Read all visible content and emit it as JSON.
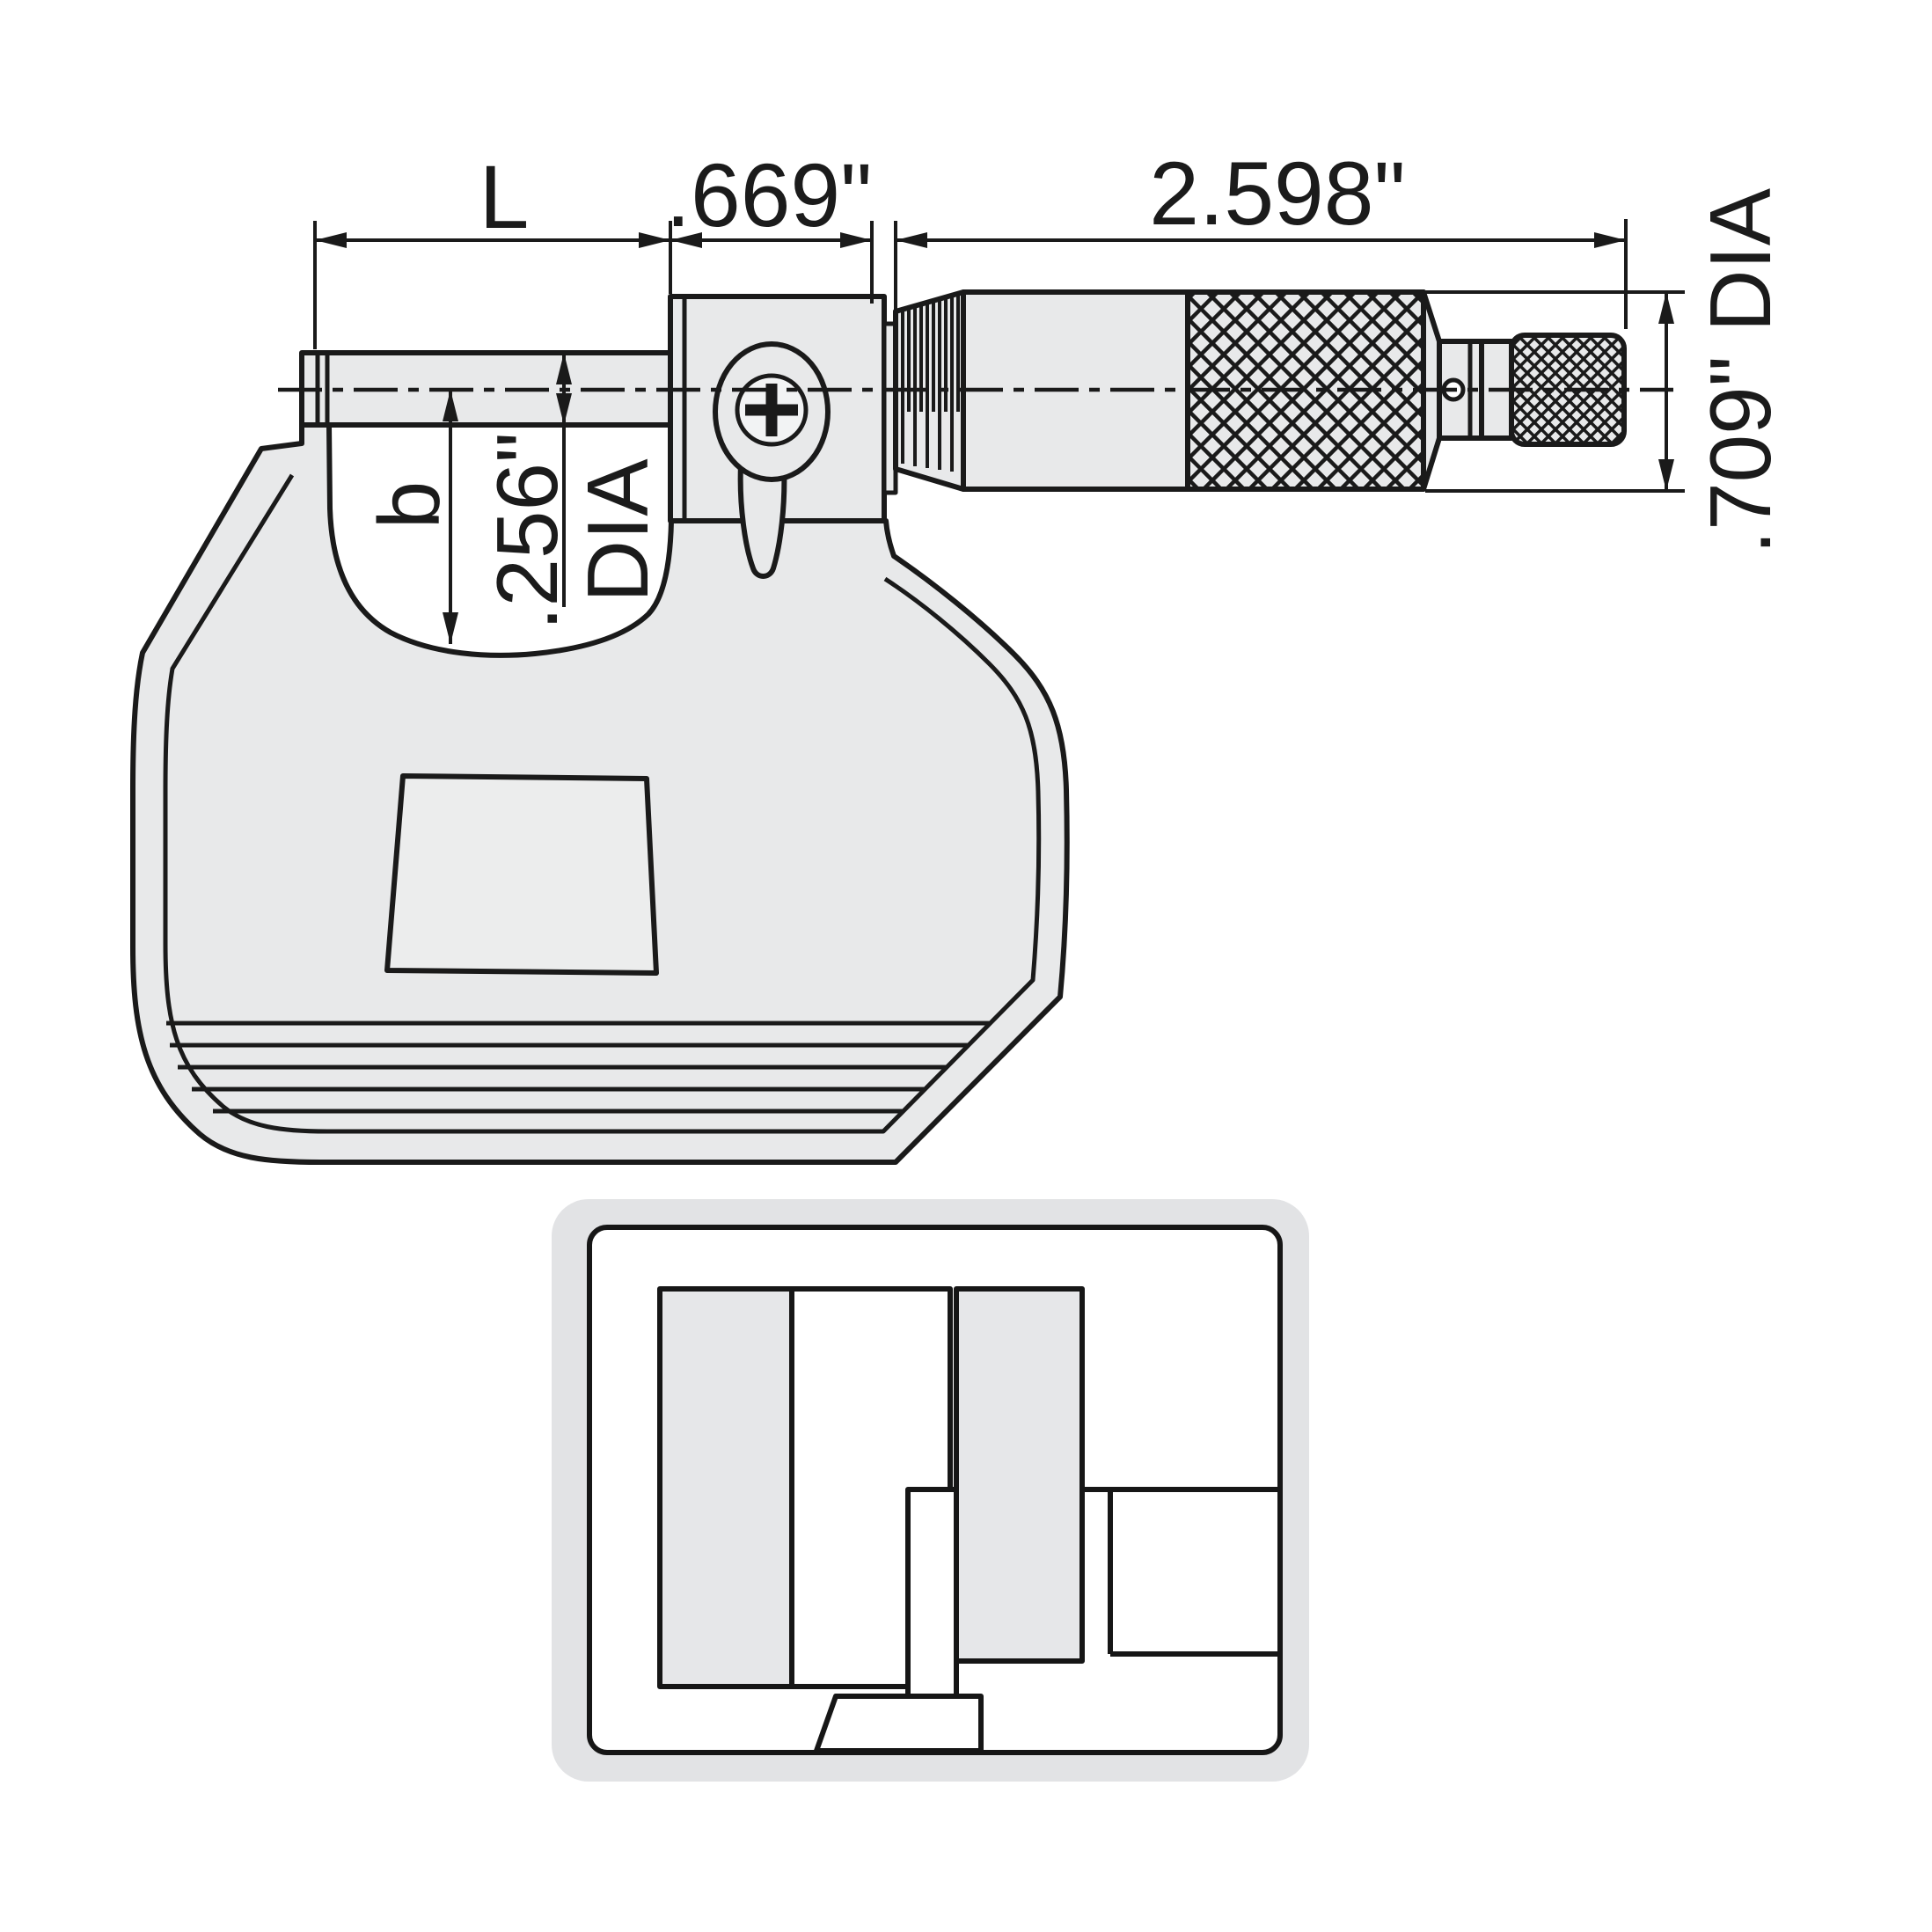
{
  "colors": {
    "line": "#1a1a1a",
    "metal_fill": "#e8e9ea",
    "metal_fill_light": "#eceded",
    "photo_background": "#e2e3e5",
    "white": "#ffffff"
  },
  "drawing": {
    "type": "micrometer-technical-drawing",
    "dim_L": "L",
    "dim_669": ".669\"",
    "dim_2598": "2.598\"",
    "dim_709": ".709\" DIA",
    "dim_b": "b",
    "dim_256": ".256\"",
    "dim_256_suffix": "DIA"
  }
}
